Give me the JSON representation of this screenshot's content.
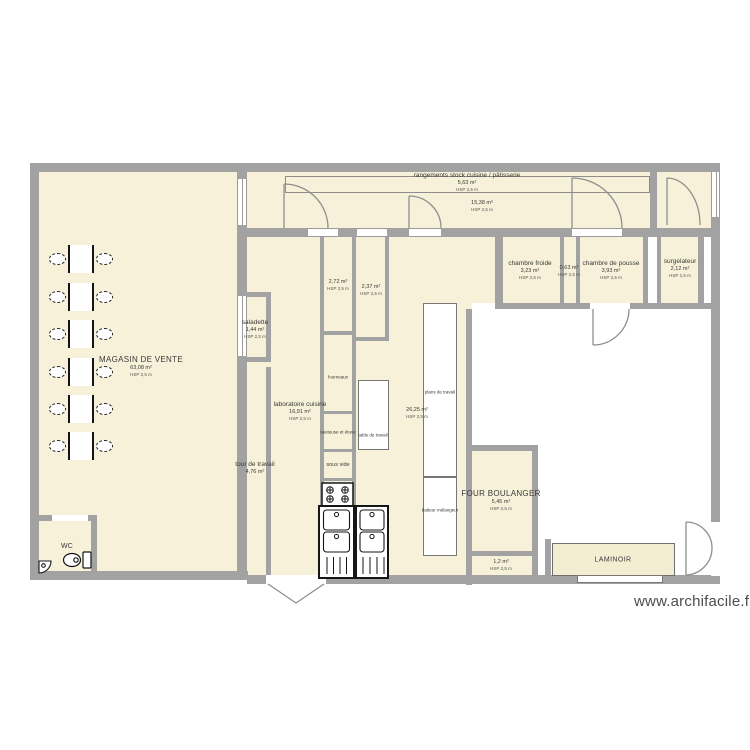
{
  "plan": {
    "watermark": "www.archifacile.fr",
    "rooms": {
      "magasin": {
        "name": "MAGASIN DE VENTE",
        "area": "63,08 m²",
        "hsp": "HSP 2,5 m"
      },
      "rangements": {
        "name": "rangements stock cuisine / pâtisserie",
        "area": "5,63 m²",
        "hsp": "HSP 2,5 m"
      },
      "couloir": {
        "area": "15,38 m²",
        "hsp": "HSP 2,5 m"
      },
      "chambre_froide": {
        "name": "chambre froide",
        "area": "3,23 m²",
        "hsp": "HSP 2,5 m"
      },
      "sas": {
        "area": "0,63 m²",
        "hsp": "HSP 2,5 m"
      },
      "chambre_pousse": {
        "name": "chambre de pousse",
        "area": "3,93 m²",
        "hsp": "HSP 2,5 m"
      },
      "surgelateur": {
        "name": "surgelateur",
        "area": "2,12 m²",
        "hsp": "HSP 2,5 m"
      },
      "saladette": {
        "name": "saladette",
        "area": "1,44 m²",
        "hsp": "HSP 2,5 m"
      },
      "reserve_272": {
        "area": "2,72 m²",
        "hsp": "HSP 2,5 m"
      },
      "reserve_237": {
        "area": "2,37 m²",
        "hsp": "HSP 2,5 m"
      },
      "laboratoire": {
        "name": "laboratoire cuisine",
        "area": "16,91 m²",
        "hsp": "HSP 2,5 m"
      },
      "cuisine": {
        "area": "26,25 m²",
        "hsp": "HSP 2,5 m"
      },
      "tour_de_travail": {
        "name": "tour de travail",
        "area": "4,76 m²"
      },
      "four_boulanger": {
        "name": "FOUR BOULANGER",
        "area": "5,45 m²",
        "hsp": "HSP 2,5 m"
      },
      "petit_local": {
        "area": "1,2 m²",
        "hsp": "HSP 2,5 m"
      },
      "wc": {
        "name": "WC"
      }
    },
    "equipment": {
      "fourneaux": "fourneaux",
      "sauteuse_etuve": "sauteuse et étuve",
      "sous_vide": "sous vide",
      "table_de_travail": "table de travail",
      "plans_de_travail": "plans de travail",
      "batteur_melangeur": "batteur mélangeur",
      "laminoir": "LAMINOIR"
    },
    "colors": {
      "wall": "#a2a2a2",
      "floor": "#f6f1d8",
      "linework": "#8f8f8f",
      "text": "#3a3a3a"
    }
  }
}
